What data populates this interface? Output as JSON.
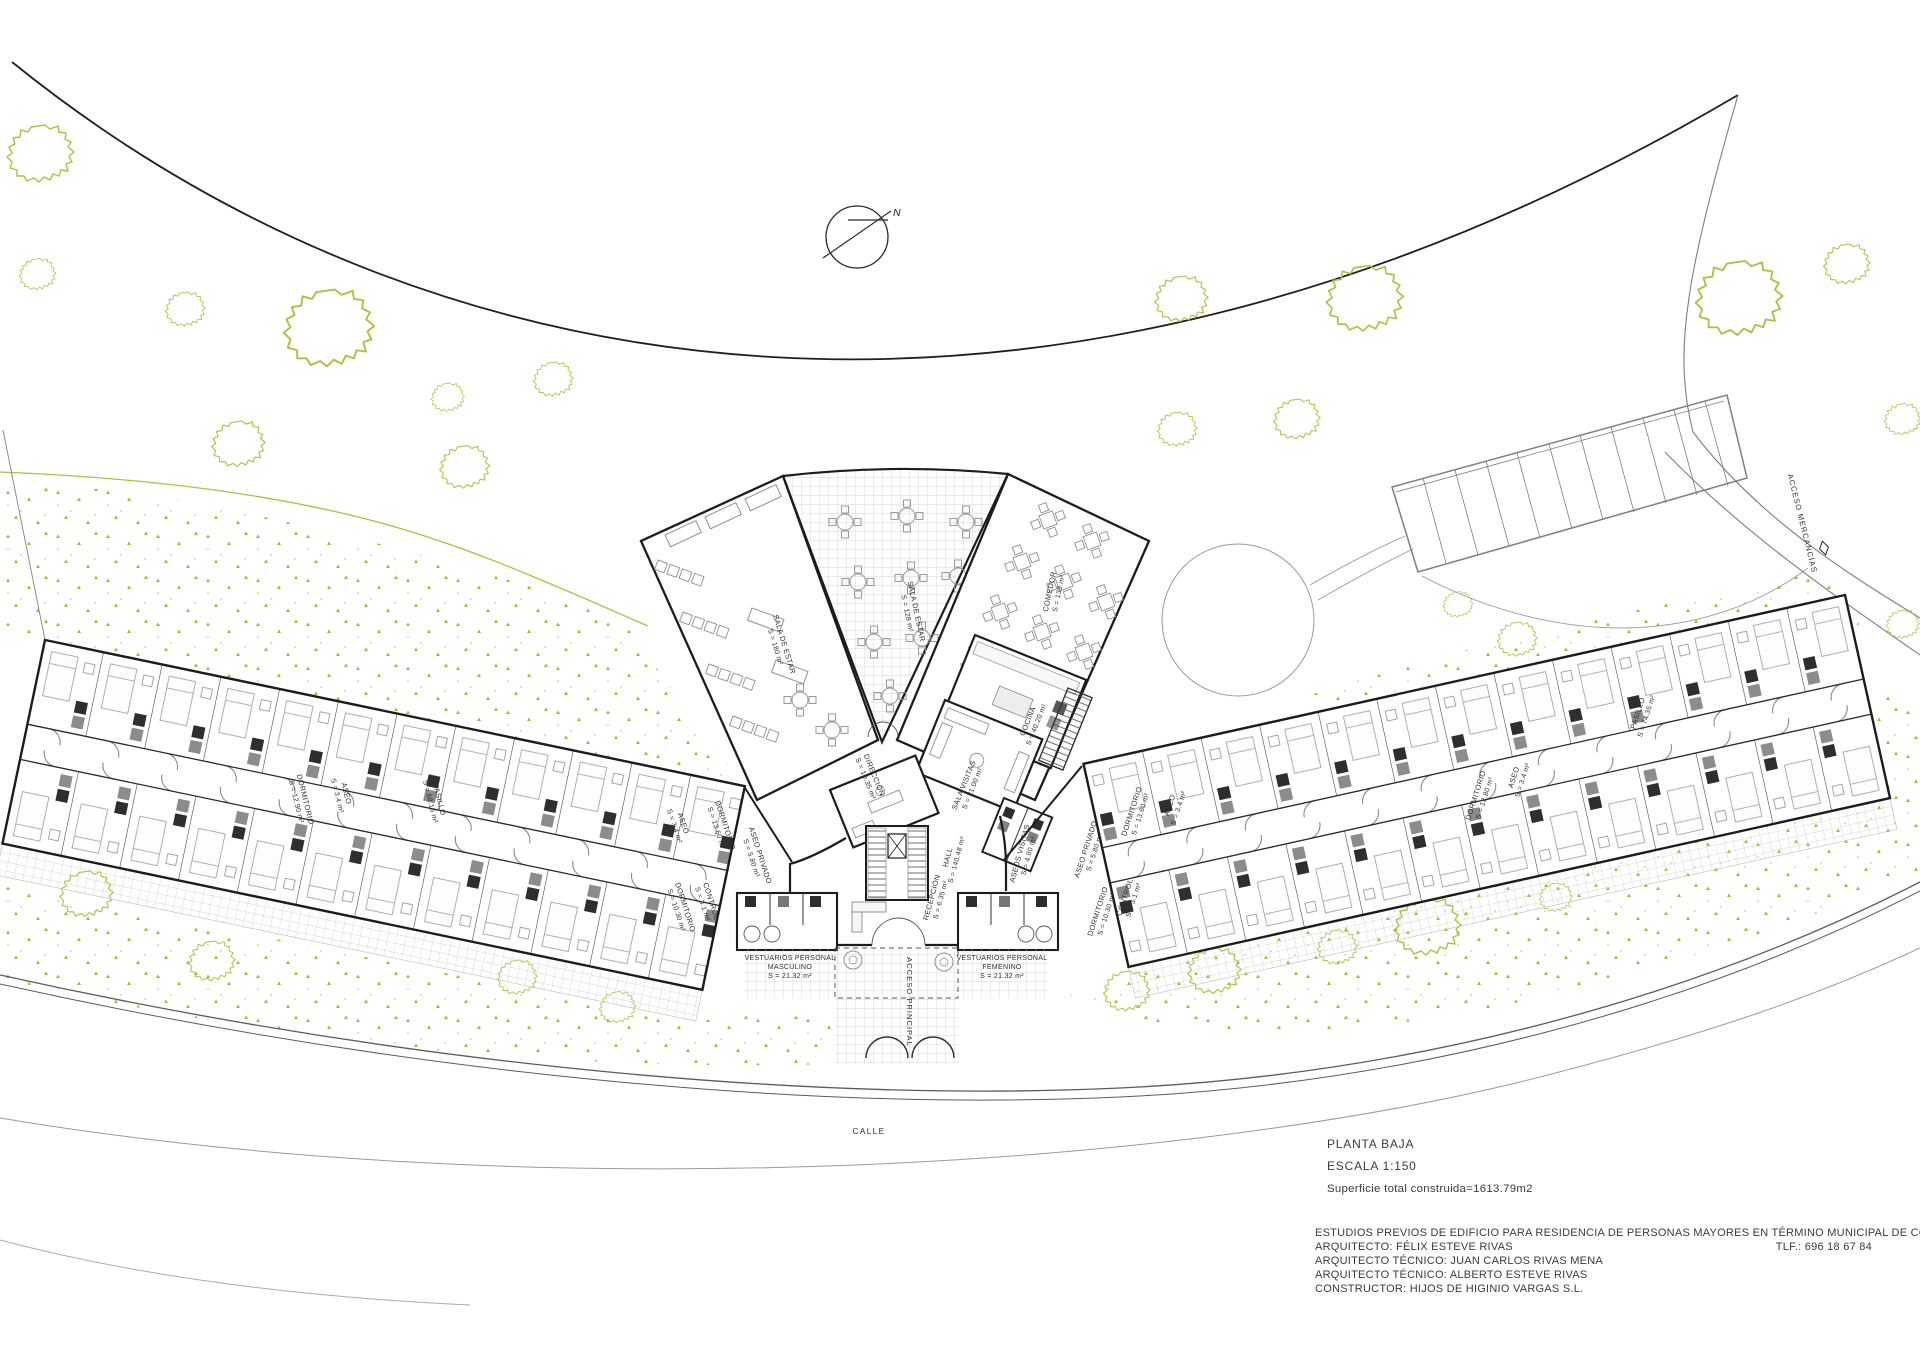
{
  "compass": {
    "north": "N"
  },
  "site": {
    "calle": "CALLE",
    "acceso_principal": "ACCESO PRINCIPAL",
    "acceso_mercancias": "ACCESO MERCANCÍAS"
  },
  "rooms": [
    {
      "n": "SALA DE ESTAR",
      "a": "S = 180 m²"
    },
    {
      "n": "SALA DE ESTAR",
      "a": "S = 128 m²"
    },
    {
      "n": "COMEDOR",
      "a": "S = 139 m²"
    },
    {
      "n": "COCINA",
      "a": "S = 40.20 m²"
    },
    {
      "n": "SALA VISITAS",
      "a": "S = 21.00 m²"
    },
    {
      "n": "DIRECCIÓN",
      "a": "S = 10.35 m²"
    },
    {
      "n": "HALL",
      "a": "S = 140.48 m²"
    },
    {
      "n": "RECEPCIÓN",
      "a": "S = 6.35 m²"
    },
    {
      "n": "ASEOS VISITAS",
      "a": "S = 4.80 m²"
    },
    {
      "n": "DORMITORIO",
      "a": "S = 12.90 m²"
    },
    {
      "n": "ASEO",
      "a": "S = 3.4 m²"
    },
    {
      "n": "PASILLO",
      "a": "S = 68.16 m²"
    },
    {
      "n": "DORMITORIO",
      "a": "S = 13.60 m²"
    },
    {
      "n": "ASEO",
      "a": "S = 3.4 m²"
    },
    {
      "n": "ASEO PRIVADO",
      "a": "S = 5.80 m²"
    },
    {
      "n": "DORMITORIO",
      "a": "S = 10.30 m²"
    },
    {
      "n": "CONTROL",
      "a": "S = 3.1 m²"
    },
    {
      "n": "DORMITORIO",
      "a": "S = 13.60 m²"
    },
    {
      "n": "ASEO",
      "a": "S = 3.4 m²"
    },
    {
      "n": "CONTROL",
      "a": "S = 3.1 m²"
    },
    {
      "n": "DORMITORIO",
      "a": "S = 10.30 m²"
    },
    {
      "n": "ASEO PRIVADO",
      "a": "S = 5.80 m²"
    },
    {
      "n": "DORMITORIO",
      "a": "S = 12.80 m²"
    },
    {
      "n": "ASEO",
      "a": "S = 3.4 m²"
    },
    {
      "n": "PASILLO",
      "a": "S = 74.35 m²"
    }
  ],
  "vest_m": [
    "VESTUARIOS PERSONAL",
    "MASCULINO",
    "S = 21.32 m²"
  ],
  "vest_f": [
    "VESTUARIOS PERSONAL",
    "FEMENINO",
    "S = 21.32 m²"
  ],
  "title_block": {
    "title": "PLANTA BAJA",
    "scale": "ESCALA 1:150",
    "total": "Superficie total construida=1613.79m2"
  },
  "credits": {
    "project": "ESTUDIOS PREVIOS DE EDIFICIO PARA RESIDENCIA DE PERSONAS MAYORES EN TÉRMINO MUNICIPAL DE COIN",
    "architect": "ARQUITECTO: FÉLIX ESTEVE RIVAS",
    "phone": "TLF.: 696 18 67 84",
    "tech1": "ARQUITECTO TÉCNICO: JUAN CARLOS RIVAS MENA",
    "tech2": "ARQUITECTO TÉCNICO: ALBERTO ESTEVE RIVAS",
    "builder": "CONSTRUCTOR: HIJOS DE HIGINIO VARGAS S.L."
  },
  "colors": {
    "vegetation": "#a2c63e",
    "walls": "#1c1c1c",
    "hatch": "#c9c9c9"
  }
}
